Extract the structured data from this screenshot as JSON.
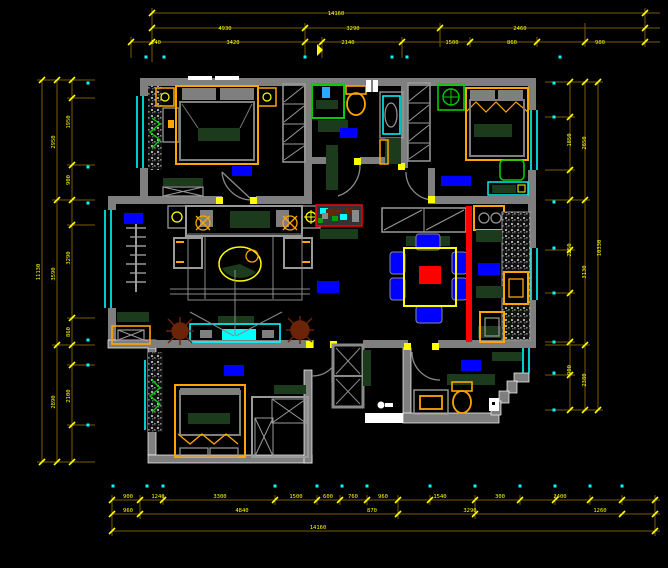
{
  "drawing": {
    "type": "cad-floor-plan",
    "background": "#000000"
  },
  "colors": {
    "wall": "#7f7f7f",
    "wall_edge": "#ffffff",
    "dim_line": "#7a5c00",
    "dim_tick": "#ffff00",
    "dim_text": "#ffff00",
    "window": "#00ffff",
    "furniture_frame": "#ffa500",
    "furniture_dark": "#1c3b1c",
    "fixture_green": "#00cc00",
    "label_block": "#0000ff",
    "accent_red": "#ff0000",
    "plant_brown": "#6b2408",
    "threshold": "#ffffff"
  },
  "dimensions": {
    "top": [
      {
        "x": 336,
        "y": 15,
        "text": "14160"
      },
      {
        "x": 225,
        "y": 30,
        "text": "4930"
      },
      {
        "x": 353,
        "y": 30,
        "text": "3290"
      },
      {
        "x": 520,
        "y": 30,
        "text": "2460"
      },
      {
        "x": 156,
        "y": 44,
        "text": "240"
      },
      {
        "x": 233,
        "y": 44,
        "text": "3420"
      },
      {
        "x": 348,
        "y": 44,
        "text": "2140"
      },
      {
        "x": 452,
        "y": 44,
        "text": "1500"
      },
      {
        "x": 512,
        "y": 44,
        "text": "860"
      },
      {
        "x": 600,
        "y": 44,
        "text": "900"
      }
    ],
    "left": [
      {
        "x": 40,
        "y": 272,
        "text": "11130",
        "rot": -90
      },
      {
        "x": 55,
        "y": 142,
        "text": "2950",
        "rot": -90
      },
      {
        "x": 55,
        "y": 274,
        "text": "3590",
        "rot": -90
      },
      {
        "x": 55,
        "y": 402,
        "text": "2890",
        "rot": -90
      },
      {
        "x": 70,
        "y": 122,
        "text": "1950",
        "rot": -90
      },
      {
        "x": 70,
        "y": 180,
        "text": "900",
        "rot": -90
      },
      {
        "x": 70,
        "y": 258,
        "text": "3290",
        "rot": -90
      },
      {
        "x": 70,
        "y": 332,
        "text": "860",
        "rot": -90
      },
      {
        "x": 70,
        "y": 396,
        "text": "2100",
        "rot": -90
      }
    ],
    "right": [
      {
        "x": 601,
        "y": 248,
        "text": "10330",
        "rot": -90
      },
      {
        "x": 586,
        "y": 143,
        "text": "2850",
        "rot": -90
      },
      {
        "x": 586,
        "y": 272,
        "text": "3130",
        "rot": -90
      },
      {
        "x": 586,
        "y": 380,
        "text": "2380",
        "rot": -90
      },
      {
        "x": 571,
        "y": 140,
        "text": "1850",
        "rot": -90
      },
      {
        "x": 571,
        "y": 250,
        "text": "2250",
        "rot": -90
      },
      {
        "x": 571,
        "y": 370,
        "text": "900",
        "rot": -90
      }
    ],
    "bottom": [
      {
        "x": 128,
        "y": 498,
        "text": "900"
      },
      {
        "x": 158,
        "y": 498,
        "text": "1240"
      },
      {
        "x": 220,
        "y": 498,
        "text": "3300"
      },
      {
        "x": 296,
        "y": 498,
        "text": "1500"
      },
      {
        "x": 328,
        "y": 498,
        "text": "600"
      },
      {
        "x": 353,
        "y": 498,
        "text": "760"
      },
      {
        "x": 383,
        "y": 498,
        "text": "960"
      },
      {
        "x": 440,
        "y": 498,
        "text": "1540"
      },
      {
        "x": 500,
        "y": 498,
        "text": "300"
      },
      {
        "x": 560,
        "y": 498,
        "text": "2400"
      },
      {
        "x": 128,
        "y": 512,
        "text": "960"
      },
      {
        "x": 242,
        "y": 512,
        "text": "4840"
      },
      {
        "x": 372,
        "y": 512,
        "text": "870"
      },
      {
        "x": 470,
        "y": 512,
        "text": "3290"
      },
      {
        "x": 600,
        "y": 512,
        "text": "1260"
      },
      {
        "x": 318,
        "y": 529,
        "text": "14160"
      }
    ]
  },
  "ticks": {
    "top": [
      [
        152,
        13
      ],
      [
        645,
        13
      ],
      [
        152,
        28
      ],
      [
        305,
        28
      ],
      [
        440,
        28
      ],
      [
        645,
        28
      ],
      [
        131,
        42
      ],
      [
        152,
        42
      ],
      [
        305,
        42
      ],
      [
        322,
        42
      ],
      [
        402,
        42
      ],
      [
        470,
        42
      ],
      [
        537,
        42
      ],
      [
        585,
        42
      ],
      [
        645,
        42
      ]
    ],
    "left": [
      [
        42,
        80
      ],
      [
        42,
        462
      ],
      [
        57,
        80
      ],
      [
        57,
        200
      ],
      [
        57,
        345
      ],
      [
        57,
        462
      ],
      [
        72,
        80
      ],
      [
        72,
        98
      ],
      [
        72,
        165
      ],
      [
        72,
        200
      ],
      [
        72,
        225
      ],
      [
        72,
        318
      ],
      [
        72,
        345
      ],
      [
        72,
        365
      ],
      [
        72,
        425
      ],
      [
        72,
        462
      ]
    ],
    "right": [
      [
        598,
        82
      ],
      [
        598,
        410
      ],
      [
        585,
        82
      ],
      [
        585,
        200
      ],
      [
        585,
        345
      ],
      [
        585,
        410
      ],
      [
        570,
        82
      ],
      [
        570,
        117
      ],
      [
        570,
        170
      ],
      [
        570,
        200
      ],
      [
        570,
        250
      ],
      [
        570,
        293
      ],
      [
        570,
        342
      ],
      [
        570,
        375
      ],
      [
        570,
        410
      ]
    ],
    "bottom": [
      [
        112,
        500
      ],
      [
        140,
        500
      ],
      [
        163,
        500
      ],
      [
        275,
        500
      ],
      [
        317,
        500
      ],
      [
        340,
        500
      ],
      [
        367,
        500
      ],
      [
        398,
        500
      ],
      [
        430,
        500
      ],
      [
        475,
        500
      ],
      [
        520,
        500
      ],
      [
        555,
        500
      ],
      [
        590,
        500
      ],
      [
        622,
        500
      ],
      [
        655,
        500
      ],
      [
        112,
        514
      ],
      [
        140,
        514
      ],
      [
        398,
        514
      ],
      [
        475,
        514
      ],
      [
        622,
        514
      ],
      [
        655,
        514
      ],
      [
        112,
        531
      ],
      [
        655,
        531
      ]
    ]
  },
  "axis_dots": [
    [
      146,
      57
    ],
    [
      164,
      57
    ],
    [
      305,
      57
    ],
    [
      392,
      57
    ],
    [
      407,
      57
    ],
    [
      560,
      57
    ],
    [
      113,
      486
    ],
    [
      147,
      486
    ],
    [
      163,
      486
    ],
    [
      275,
      486
    ],
    [
      317,
      486
    ],
    [
      342,
      486
    ],
    [
      367,
      486
    ],
    [
      430,
      486
    ],
    [
      475,
      486
    ],
    [
      520,
      486
    ],
    [
      555,
      486
    ],
    [
      590,
      486
    ],
    [
      622,
      486
    ],
    [
      88,
      83
    ],
    [
      88,
      167
    ],
    [
      88,
      203
    ],
    [
      88,
      340
    ],
    [
      88,
      365
    ],
    [
      88,
      425
    ],
    [
      554,
      83
    ],
    [
      554,
      117
    ],
    [
      554,
      202
    ],
    [
      554,
      248
    ],
    [
      554,
      293
    ],
    [
      554,
      342
    ],
    [
      554,
      373
    ],
    [
      554,
      410
    ]
  ],
  "label_blocks": [
    {
      "x": 232,
      "y": 166,
      "w": 20,
      "h": 10,
      "color": "#0000ff"
    },
    {
      "x": 340,
      "y": 128,
      "w": 17,
      "h": 10,
      "color": "#0000ff"
    },
    {
      "x": 441,
      "y": 176,
      "w": 30,
      "h": 10,
      "color": "#0000ff"
    },
    {
      "x": 124,
      "y": 213,
      "w": 19,
      "h": 11,
      "color": "#0000ff"
    },
    {
      "x": 317,
      "y": 281,
      "w": 22,
      "h": 12,
      "color": "#0000ff"
    },
    {
      "x": 478,
      "y": 263,
      "w": 22,
      "h": 12,
      "color": "#0000ff"
    },
    {
      "x": 224,
      "y": 365,
      "w": 20,
      "h": 11,
      "color": "#0000ff"
    },
    {
      "x": 461,
      "y": 360,
      "w": 20,
      "h": 11,
      "color": "#0000ff"
    }
  ],
  "entry_threshold": {
    "x": 365,
    "y": 413,
    "w": 38,
    "h": 10,
    "color": "#ffffff"
  }
}
